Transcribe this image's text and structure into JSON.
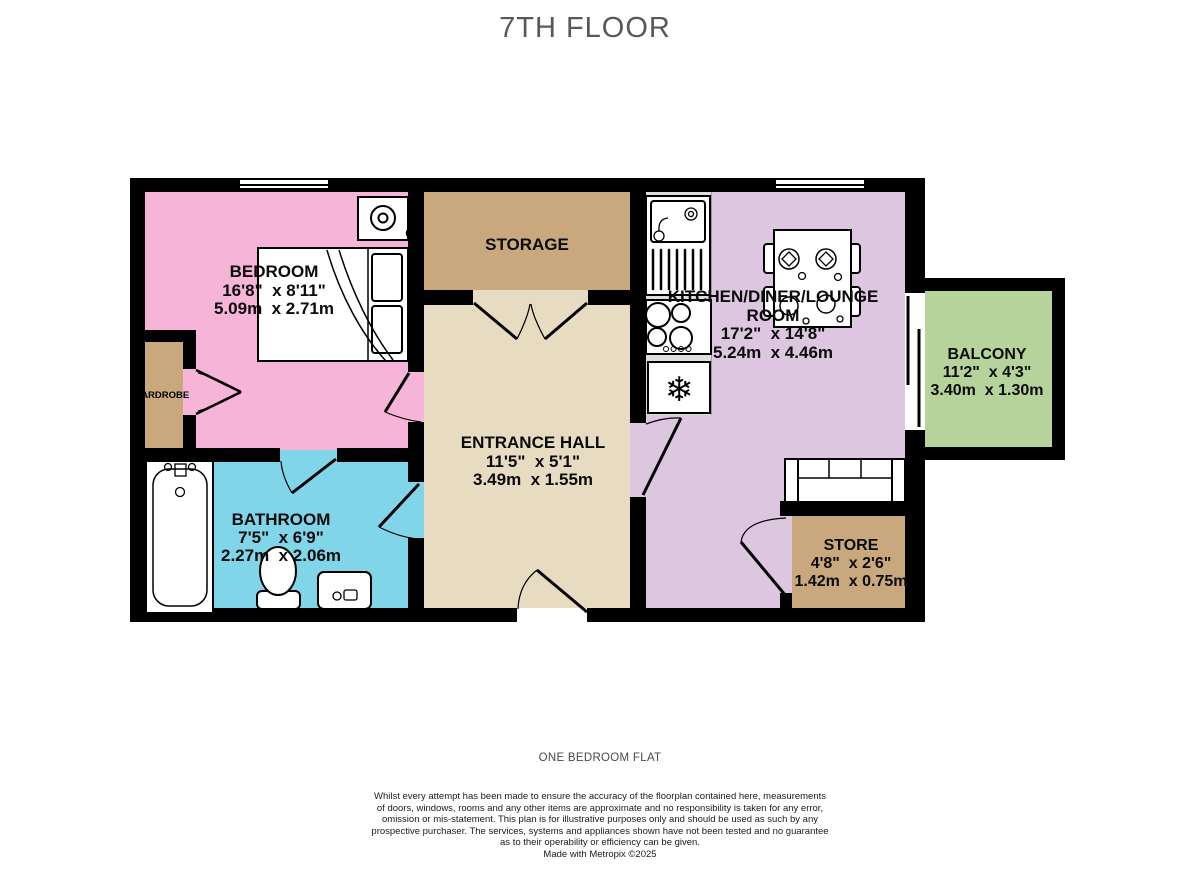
{
  "title": "7TH FLOOR",
  "rooms": {
    "bedroom": {
      "name": "BEDROOM",
      "imperial": "16'8\"  x 8'11\"",
      "metric": "5.09m  x 2.71m"
    },
    "storage": {
      "name": "STORAGE"
    },
    "kitchen": {
      "name_line1": "KITCHEN/DINER/LOUNGE",
      "name_line2": "ROOM",
      "imperial": "17'2\"  x 14'8\"",
      "metric": "5.24m  x 4.46m"
    },
    "balcony": {
      "name": "BALCONY",
      "imperial": "11'2\"  x 4'3\"",
      "metric": "3.40m  x 1.30m"
    },
    "entrance_hall": {
      "name": "ENTRANCE HALL",
      "imperial": "11'5\"  x 5'1\"",
      "metric": "3.49m  x 1.55m"
    },
    "bathroom": {
      "name": "BATHROOM",
      "imperial": "7'5\"  x 6'9\"",
      "metric": "2.27m  x 2.06m"
    },
    "store": {
      "name": "STORE",
      "imperial": "4'8\"  x 2'6\"",
      "metric": "1.42m  x 0.75m"
    },
    "wardrobe": {
      "name": "WARDROBE"
    }
  },
  "icons": {
    "fridge_snowflake": "❄"
  },
  "colors": {
    "bedroom": "#f6b4d8",
    "bathroom": "#80d5e8",
    "storage": "#c9a87e",
    "hall": "#e7dcc1",
    "lounge": "#dcc6e0",
    "store": "#c9a87e",
    "wardrobe": "#c9a87e",
    "balcony": "#b6d39c",
    "counter": "#dedede",
    "wall": "#000000"
  },
  "footer": {
    "caption": "ONE BEDROOM FLAT",
    "disclaimer_lines": [
      "Whilst every attempt has been made to ensure the accuracy of the floorplan contained here, measurements",
      "of doors, windows, rooms and any other items are approximate and no responsibility is taken for any error,",
      "omission or mis-statement. This plan is for illustrative purposes only and should be used as such by any",
      "prospective purchaser. The services, systems and appliances shown have not been tested and no guarantee",
      "as to their operability or efficiency can be given."
    ],
    "credit": "Made with Metropix ©2025"
  }
}
